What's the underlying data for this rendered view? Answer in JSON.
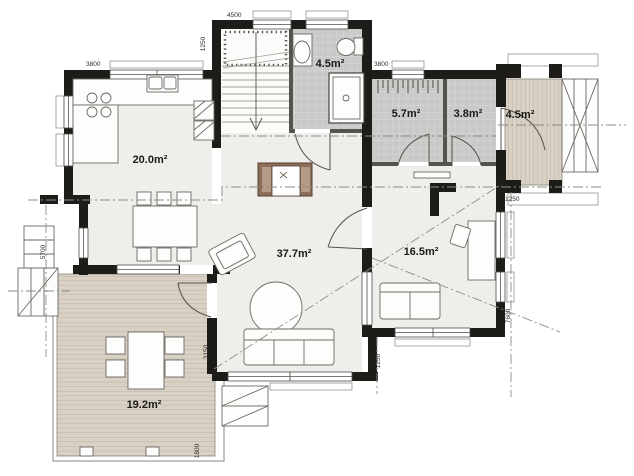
{
  "plan": {
    "type": "house-floor-plan",
    "rooms": [
      {
        "id": "kitchen",
        "area_label": "20.0m²"
      },
      {
        "id": "bathroom",
        "area_label": "4.5m²"
      },
      {
        "id": "storage",
        "area_label": "5.7m²"
      },
      {
        "id": "wc",
        "area_label": "3.8m²"
      },
      {
        "id": "entry-porch",
        "area_label": "4.5m²"
      },
      {
        "id": "living-room",
        "area_label": "37.7m²"
      },
      {
        "id": "bedroom",
        "area_label": "16.5m²"
      },
      {
        "id": "terrace",
        "area_label": "19.2m²"
      }
    ],
    "dimensions": {
      "top_block_width": "4500",
      "top_block_offset": "1250",
      "kitchen_width": "3800",
      "east_wing_width": "3800",
      "west_side": "5700",
      "east_side": "7600",
      "porch_depth": "1250",
      "southeast_offset": "1250",
      "terrace_side": "3150",
      "terrace_step": "1800"
    },
    "colors": {
      "wall": "#1d1c19",
      "floor": "#efeeeb",
      "tile": "#c9c9c7",
      "deck": "#d8d1c4",
      "fireplace": "#8d6e5b",
      "outline": "#55534f",
      "section_line": "#8c8c88",
      "background": "#ffffff"
    }
  }
}
